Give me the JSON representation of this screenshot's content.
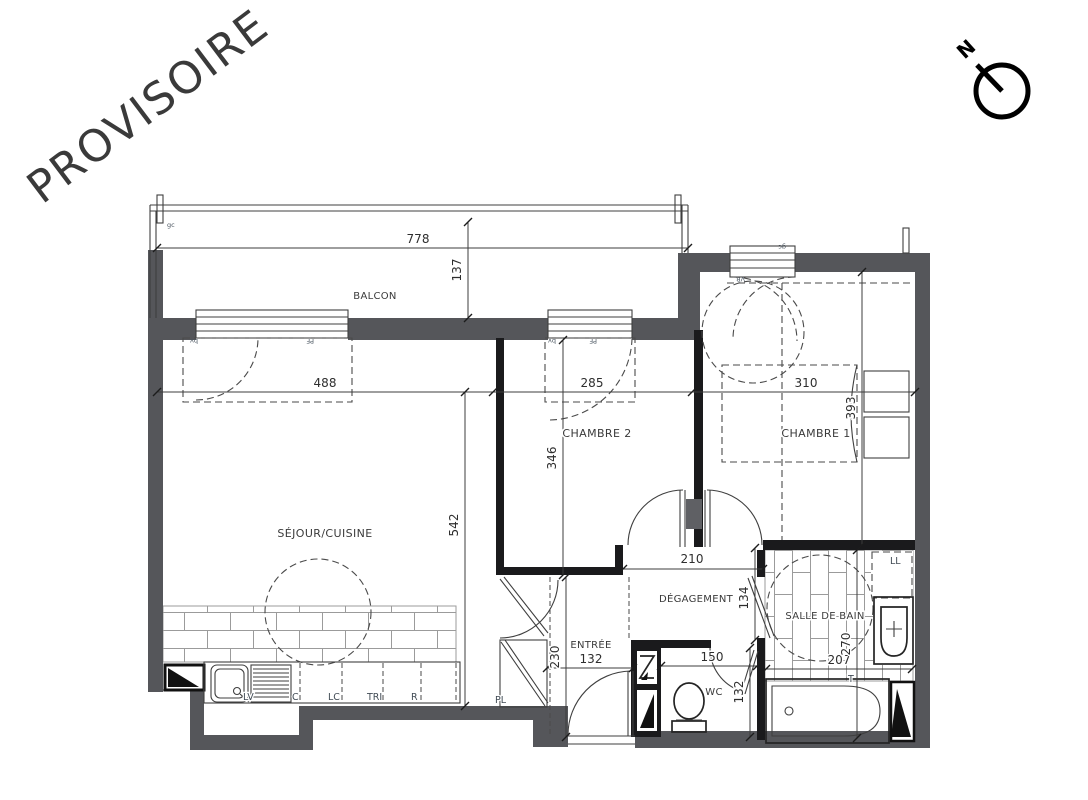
{
  "watermark": {
    "text": "PROVISOIRE",
    "color": "#e8312a"
  },
  "compass": {
    "label": "N"
  },
  "rooms": {
    "balcon": "BALCON",
    "sejour": "SÉJOUR/CUISINE",
    "chambre1": "CHAMBRE 1",
    "chambre2": "CHAMBRE 2",
    "degagement": "DÉGAGEMENT",
    "entree": "ENTRÉE",
    "salle_de_bain": "SALLE DE BAIN",
    "wc": "WC"
  },
  "dims": {
    "balcon_w": "778",
    "balcon_d": "137",
    "sejour_w": "488",
    "sejour_d": "542",
    "chambre2_w": "285",
    "chambre2_d": "346",
    "chambre1_w": "310",
    "chambre1_d": "393",
    "degagement_w": "210",
    "degagement_d": "134",
    "entree_w": "132",
    "entree_d": "230",
    "wc_w": "150",
    "wc_d": "132",
    "sdb_w": "207",
    "sdb_d": "270"
  },
  "kitchen": {
    "lv": "LV",
    "c": "C",
    "lc": "LC",
    "tri": "TRI",
    "r": "R"
  },
  "labels": {
    "pl": "PL",
    "ll": "LL",
    "t": "T"
  },
  "window_tags": {
    "pf_sejour": "PF",
    "pf_chambre2": "PF",
    "gc_balcon": "gc",
    "gc_chambre1": "gc",
    "vr": "VR",
    "bv_sejour": "bv",
    "bv_chambre2": "bv"
  }
}
